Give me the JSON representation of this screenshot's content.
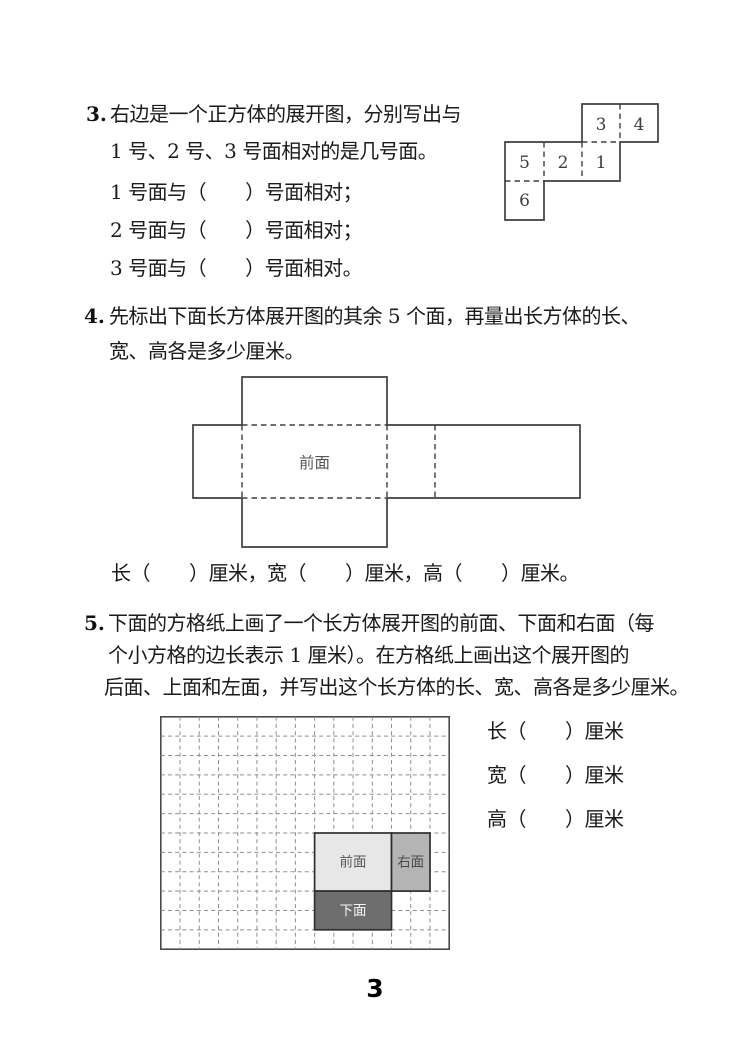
{
  "colors": {
    "text": "#1a1a1a",
    "diagram_line": "#3f3f3f",
    "grid_line": "#8f8f8f",
    "face_front_fill": "#e7e7e7",
    "face_right_fill": "#b4b4b4",
    "face_bottom_fill": "#6e6e6e",
    "face_bottom_text": "#f5f5f5"
  },
  "q3": {
    "number": "3.",
    "line1": "右边是一个正方体的展开图，分别写出与",
    "line2": "1 号、2 号、3 号面相对的是几号面。",
    "blank1": "1 号面与（　　）号面相对；",
    "blank2": "2 号面与（　　）号面相对；",
    "blank3": "3 号面与（　　）号面相对。",
    "net": {
      "f1": "1",
      "f2": "2",
      "f3": "3",
      "f4": "4",
      "f5": "5",
      "f6": "6"
    }
  },
  "q4": {
    "number": "4.",
    "line1": "先标出下面长方体展开图的其余 5 个面，再量出长方体的长、",
    "line2": "宽、高各是多少厘米。",
    "front_label": "前面",
    "answer_line": "长（　　）厘米，宽（　　）厘米，高（　　）厘米。"
  },
  "q5": {
    "number": "5.",
    "line1": "下面的方格纸上画了一个长方体展开图的前面、下面和右面（每",
    "line2": "个小方格的边长表示 1 厘米）。在方格纸上画出这个展开图的",
    "line3": "后面、上面和左面，并写出这个长方体的长、宽、高各是多少厘米。",
    "grid": {
      "columns": 15,
      "rows": 12,
      "front_label": "前面",
      "right_label": "右面",
      "bottom_label": "下面"
    },
    "answer1": "长（　　）厘米",
    "answer2": "宽（　　）厘米",
    "answer3": "高（　　）厘米"
  },
  "footer": {
    "page_number": "3"
  }
}
